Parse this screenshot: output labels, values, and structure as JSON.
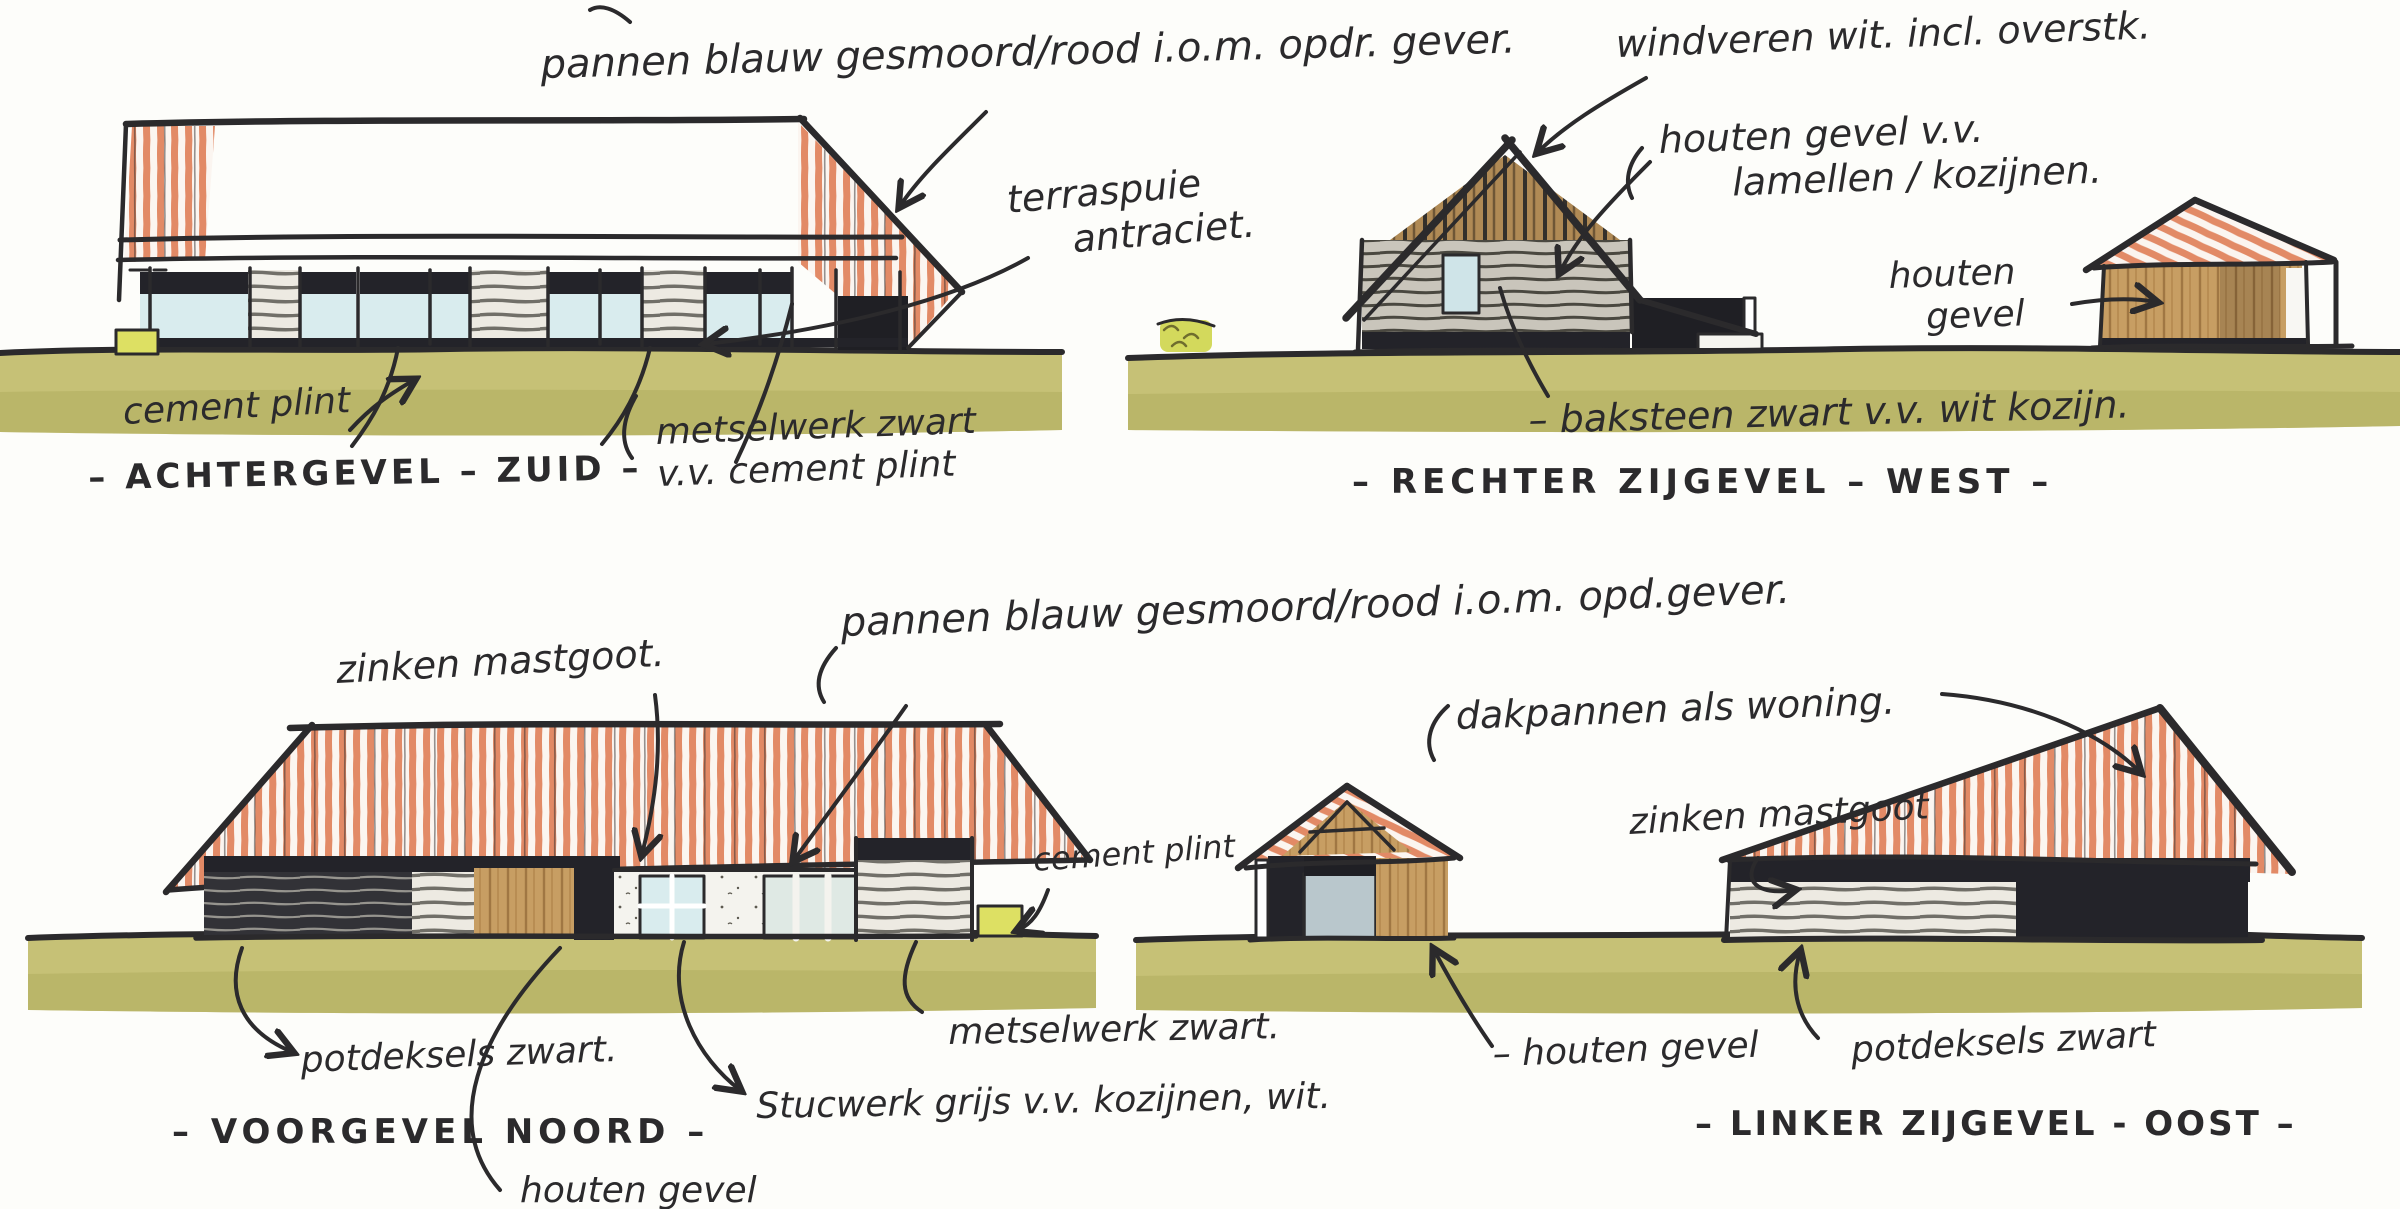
{
  "sheet": {
    "kind": "hand-drawn elevation sketches",
    "palette": {
      "ink": "#2b2a2c",
      "roof_tile_salmon": "#e28a66",
      "ground_olive": "#c6c176",
      "wood_tan": "#c79e63",
      "glass_blue": "#d9ecee",
      "plinth_black": "#232329",
      "accent_yellow_green": "#dde063",
      "paper": "#fdfdfa"
    }
  },
  "elevations": {
    "achtergevel": {
      "title": "– ACHTERGEVEL – ZUID –",
      "notes": {
        "roof": "pannen blauw gesmoord/rood i.o.m. opdr. gever.",
        "terrace_line1": "terraspuie",
        "terrace_line2": "antraciet.",
        "plinth": "cement plint",
        "masonry_line1": "metselwerk zwart",
        "masonry_line2": "v.v. cement plint"
      }
    },
    "rechter_zijgevel": {
      "title": "– RECHTER ZIJGEVEL – WEST –",
      "notes": {
        "windvanes": "windveren wit. incl. overstk.",
        "gable_line1": "houten gevel v.v.",
        "gable_line2": "lamellen / kozijnen.",
        "barn_line1": "houten",
        "barn_line2": "gevel",
        "brick": "– baksteen zwart v.v. wit kozijn."
      }
    },
    "voorgevel": {
      "title": "– VOORGEVEL NOORD –",
      "notes": {
        "gutter": "zinken mastgoot.",
        "roof": "pannen blauw gesmoord/rood i.o.m. opd.gever.",
        "plinth": "cement plint",
        "masonry": "metselwerk zwart.",
        "cladding": "potdeksels zwart.",
        "stucco": "Stucwerk grijs v.v. kozijnen, wit.",
        "timber": "houten gevel"
      }
    },
    "linker_zijgevel": {
      "title": "– LINKER ZIJGEVEL - OOST –",
      "notes": {
        "tiles": "dakpannen als woning.",
        "gutter": "zinken mastgoot",
        "timber": "– houten gevel",
        "cladding": "potdeksels zwart"
      }
    }
  }
}
